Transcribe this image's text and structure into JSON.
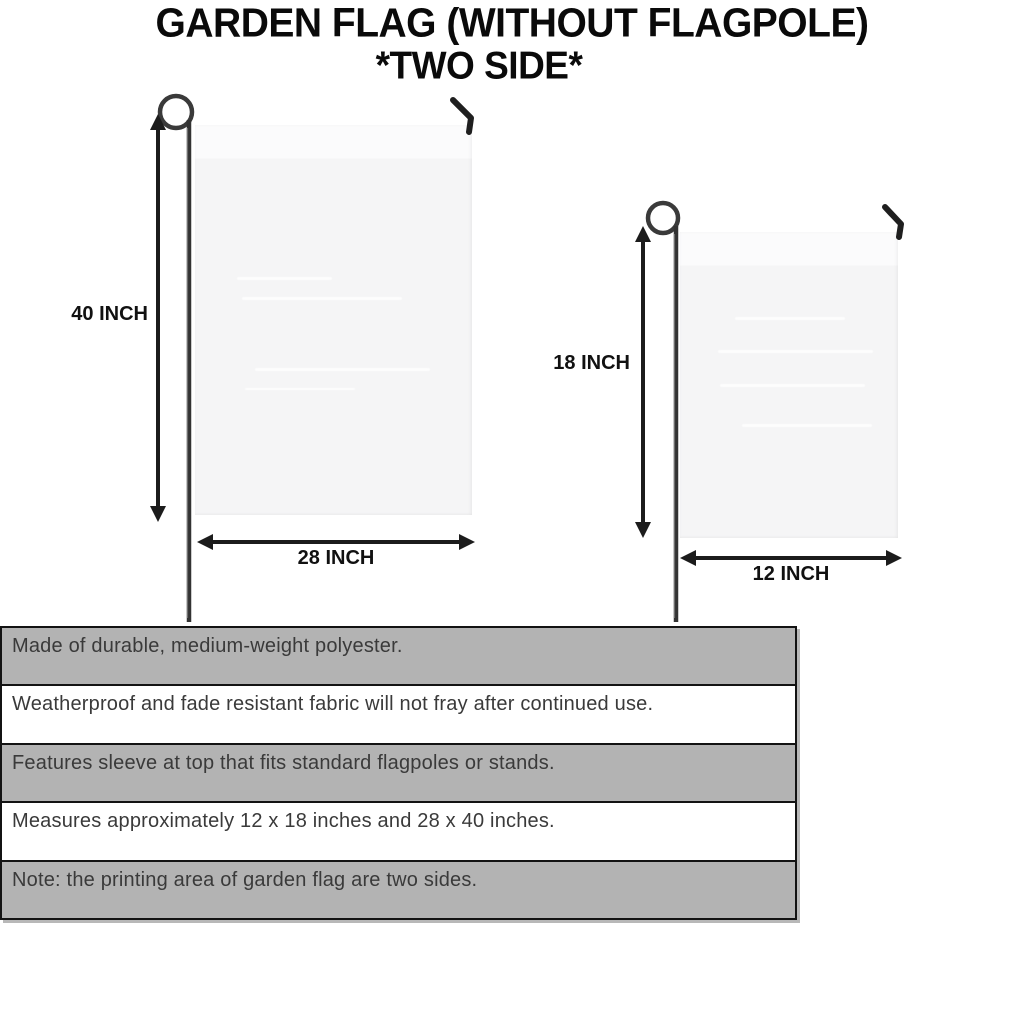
{
  "title": {
    "line1": "GARDEN FLAG (WITHOUT FLAGPOLE)",
    "line2": "*TWO SIDE*"
  },
  "large_flag": {
    "height_label": "40 INCH",
    "width_label": "28 INCH"
  },
  "small_flag": {
    "height_label": "18 INCH",
    "width_label": "12 INCH"
  },
  "spec_table": {
    "rows": [
      {
        "text": "Made of durable, medium-weight polyester."
      },
      {
        "text": "Weatherproof and fade resistant fabric will not fray after continued use."
      },
      {
        "text": "Features sleeve at top that fits standard flagpoles or stands."
      },
      {
        "text": "Measures approximately 12 x 18 inches and 28 x 40 inches."
      },
      {
        "text": "Note: the printing area of garden flag are two sides."
      }
    ]
  },
  "colors": {
    "shaded_row": "#b3b3b3",
    "row_border": "#131313",
    "flag_fabric": "#f5f5f6",
    "pole": "#3a3a3a",
    "arrow": "#1c1c1c",
    "title_text": "#0a0a0a",
    "table_text": "#3a3a3a"
  }
}
